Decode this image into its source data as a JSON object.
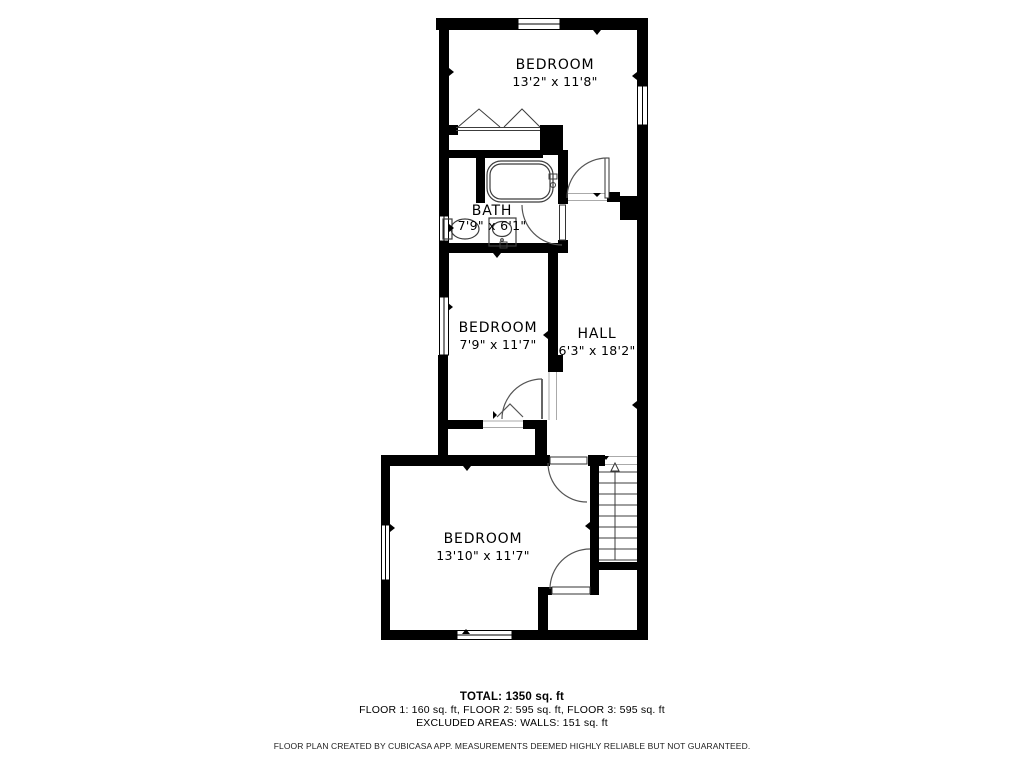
{
  "floor_plan": {
    "rooms": [
      {
        "name": "BEDROOM",
        "dimensions": "13'2\" x 11'8\""
      },
      {
        "name": "BATH",
        "dimensions": "7'9\" x 6'1\""
      },
      {
        "name": "BEDROOM",
        "dimensions": "7'9\" x 11'7\""
      },
      {
        "name": "HALL",
        "dimensions": "6'3\" x 18'2\""
      },
      {
        "name": "BEDROOM",
        "dimensions": "13'10\" x 11'7\""
      }
    ],
    "stairs": {
      "arrow_icon": "up-arrow",
      "direction": "up"
    },
    "fixtures": [
      "bathtub",
      "toilet",
      "sink-vanity",
      "closet-bifold-doors"
    ],
    "colors": {
      "wall": "#000000",
      "background": "#ffffff",
      "fixture_line": "#3c3c3c",
      "door_arc": "#555555",
      "frame_line": "#aaaaaa"
    }
  },
  "summary": {
    "total": "TOTAL: 1350 sq. ft",
    "floor_breakdown": "FLOOR 1: 160 sq. ft, FLOOR 2: 595 sq. ft, FLOOR 3: 595 sq. ft",
    "excluded_areas": "EXCLUDED AREAS: WALLS: 151 sq. ft"
  },
  "disclaimer": "FLOOR PLAN CREATED BY CUBICASA APP. MEASUREMENTS DEEMED HIGHLY RELIABLE BUT NOT GUARANTEED."
}
